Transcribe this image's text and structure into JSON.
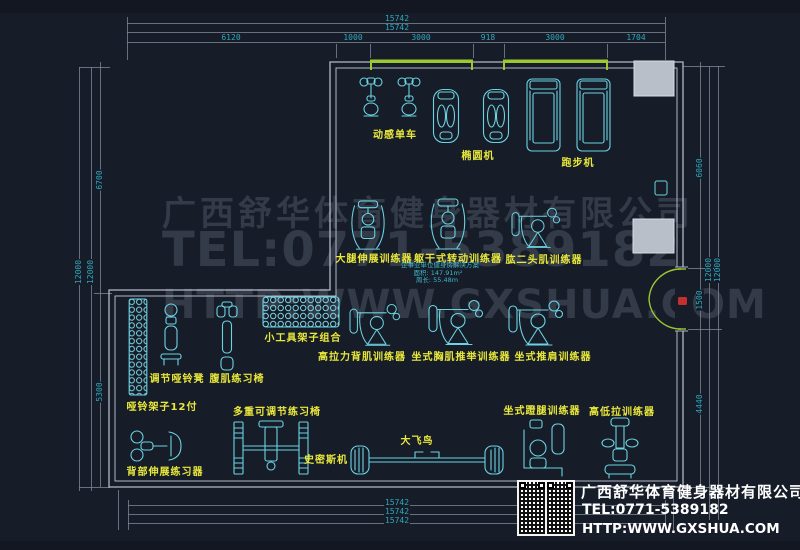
{
  "watermark": {
    "company": "广西舒华体育健身器材有限公司",
    "tel": "TEL:0771-5389182",
    "url": "HTTP:WWW.GXSHUA.COM"
  },
  "notes": {
    "title": "企事业单位健身房解决方案",
    "area": "面积: 147.91m²",
    "perimeter": "周长: 55.48m"
  },
  "labels": {
    "spin_bike": "动感单车",
    "elliptical": "椭圆机",
    "treadmill": "跑步机",
    "leg_extension": "大腿伸展训练器",
    "torso_rotation": "躯干式转动训练器",
    "biceps": "肱二头肌训练器",
    "tool_rack": "小工具架子组合",
    "lat_pulldown": "高拉力背肌训练器",
    "chest_press": "坐式胸肌推举训练器",
    "shoulder_press": "坐式推肩训练器",
    "adj_dumbbell_bench": "调节哑铃凳",
    "ab_bench": "腹肌练习椅",
    "dumbbell_rack": "哑铃架子12付",
    "multi_adj_bench": "多重可调节练习椅",
    "smith_machine": "史密斯机",
    "cable_crossover": "大飞鸟",
    "back_extension": "背部伸展练习器",
    "leg_press": "坐式蹬腿训练器",
    "hi_lo_pulley": "高低拉训练器"
  },
  "dimensions": {
    "top_total_1": "15742",
    "top_total_2": "15742",
    "top_segments": [
      "6120",
      "1000",
      "3000",
      "918",
      "3000",
      "1704"
    ],
    "bottom": [
      "15742",
      "15742",
      "15742"
    ],
    "left_totals": [
      "12000",
      "12000"
    ],
    "left_segments": [
      "6700",
      "5300"
    ],
    "right_totals": [
      "12000",
      "12000"
    ],
    "right_segments": [
      "6060",
      "1500",
      "4440"
    ]
  },
  "info_box": {
    "company": "广西舒华体育健身器材有限公司",
    "tel": "TEL:0771-5389182",
    "url": "HTTP:WWW.GXSHUA.COM"
  },
  "colors": {
    "background": "#161c28",
    "equipment": "#6cd3e2",
    "label": "#e9e83b",
    "dimension_text": "#2fa8bd",
    "dimension_line": "#7e8692",
    "wall": "#b4bac4",
    "column_fill": "#b9bfc8",
    "window_green": "#9cc832",
    "door_green": "#9cc832",
    "marker_red": "#c43030",
    "watermark": "#808ca0",
    "info_text": "#ffffff"
  }
}
